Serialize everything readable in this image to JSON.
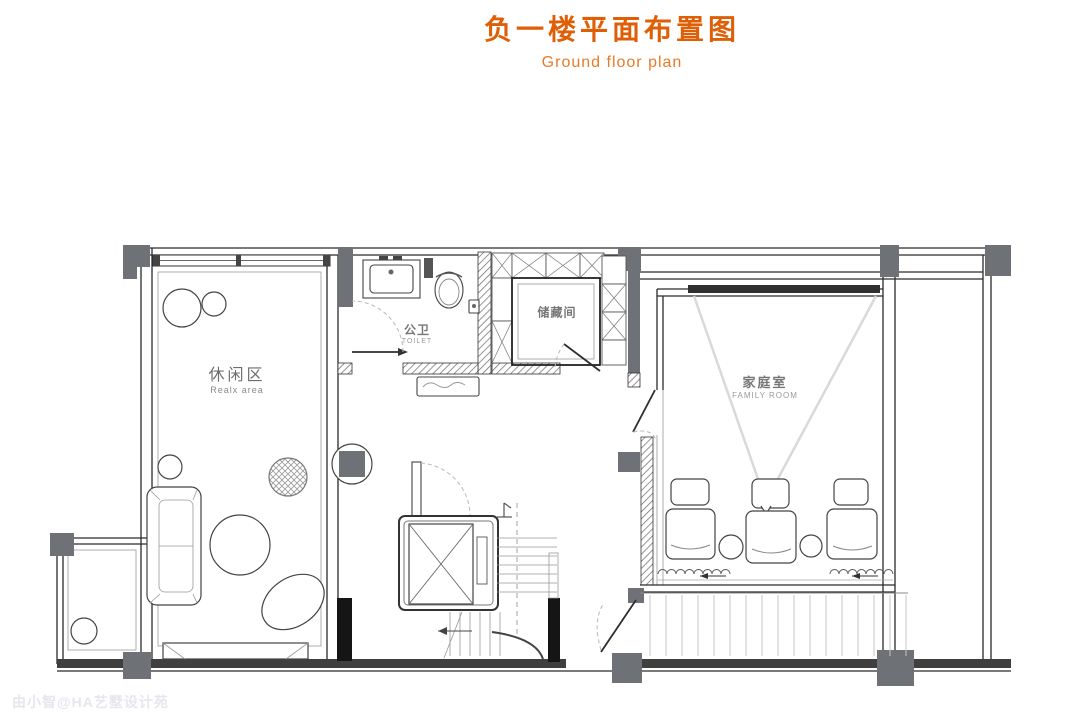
{
  "title": {
    "main": "负一楼平面布置图",
    "subtitle": "Ground floor plan"
  },
  "rooms": {
    "relax": {
      "name_zh": "休闲区",
      "name_en": "Realx area"
    },
    "toilet": {
      "name_zh": "公卫",
      "name_en": "TOILET"
    },
    "storage": {
      "name_zh": "储藏间"
    },
    "family": {
      "name_zh": "家庭室",
      "name_en": "FAMILY ROOM"
    }
  },
  "watermark": "由小智@HA艺墅设计苑",
  "colors": {
    "accent": "#DF5F07",
    "accent2": "#E87A28",
    "column-gray": "#6E7276",
    "wall-dark": "#2E2E2E",
    "watermark-gray": "#E6E6EE",
    "label-gray": "#6E6E6E"
  }
}
